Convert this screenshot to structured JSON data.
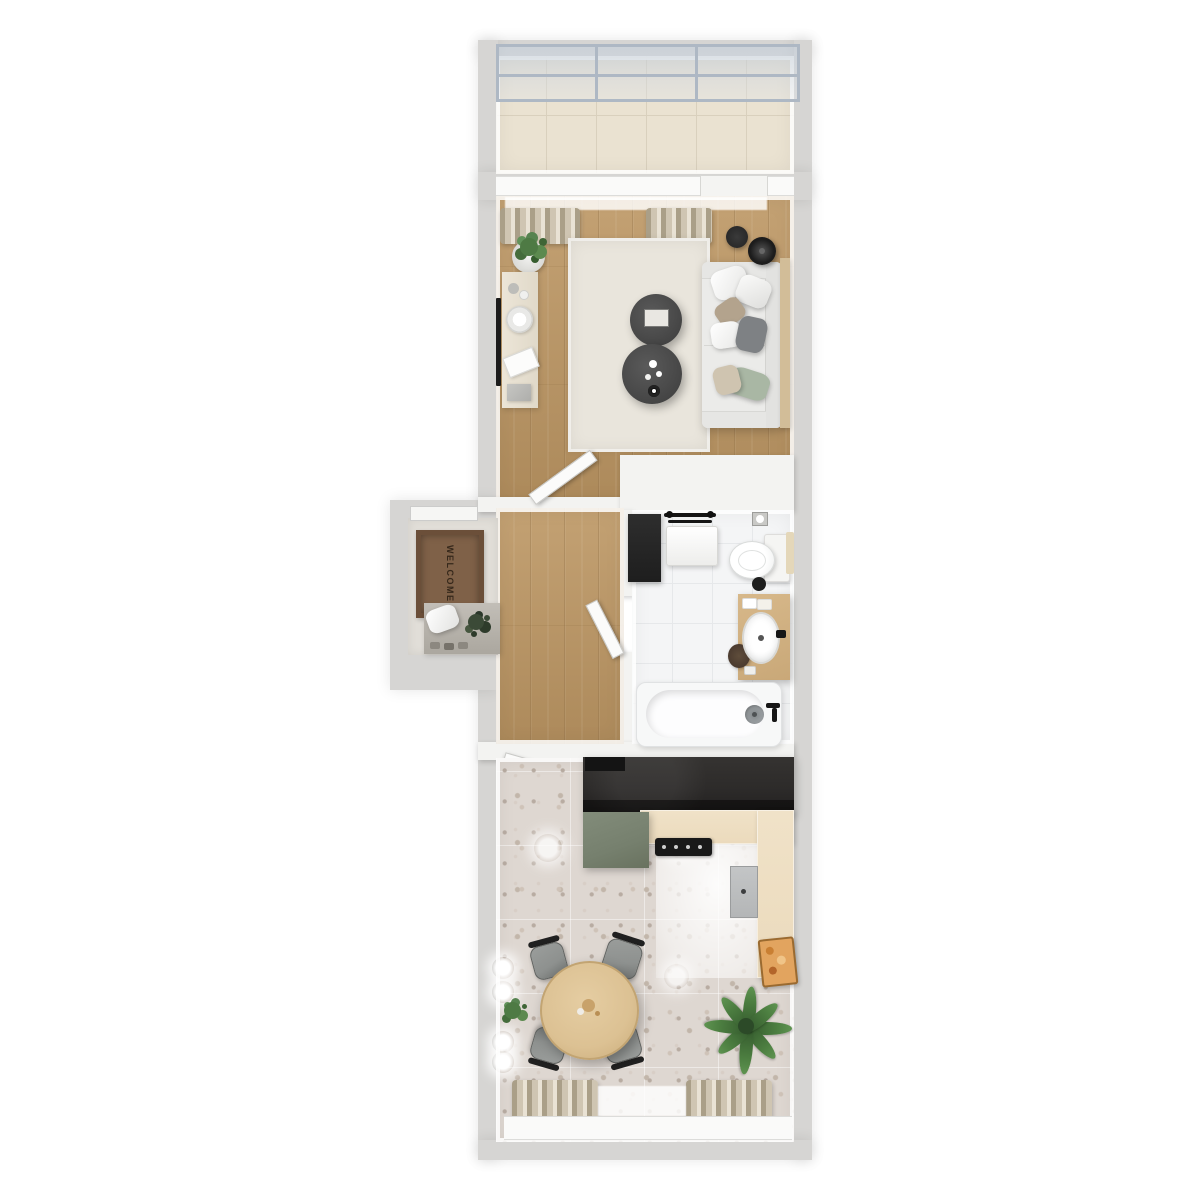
{
  "scene": {
    "type": "apartment-floor-plan-3d-render",
    "welcome_mat_label": "WELCOME"
  },
  "colors": {
    "bg": "#ffffff",
    "wall": "#d6d5d3",
    "partition": "#f3f3f1",
    "balconyTile": "#eae2d1",
    "balconyGrout": "#d9d0bd",
    "glassFrame": "#aeb8c4",
    "wood": "#c3a173",
    "woodDark": "#ad8a5b",
    "rug": "#e9e5dc",
    "sofa": "#ebebe9",
    "pillowTan": "#b3a38d",
    "pillowSage": "#a9b7a4",
    "pillowGray": "#7e8184",
    "coffeeTable": "#4a4a4a",
    "shelfWood": "#d2bd98",
    "bathTile": "#f4f5f6",
    "vanity": "#c9a878",
    "terrazzo": "#ded7d1",
    "counterDark": "#2d2b2a",
    "counterWood": "#ebdabc",
    "sageIsland": "#76806e",
    "tableWood": "#dcc193",
    "chair": "#8e918f",
    "mat": "#7f6148",
    "matBorder": "#6b4f39",
    "matText": "#36281b",
    "curtain": "#cfc5b2",
    "curtainDark": "#aa9f88",
    "green": "#4e7a44",
    "greenDark": "#2f5229",
    "appliance": "#b4b6b7",
    "tray": "#e2a45f"
  }
}
